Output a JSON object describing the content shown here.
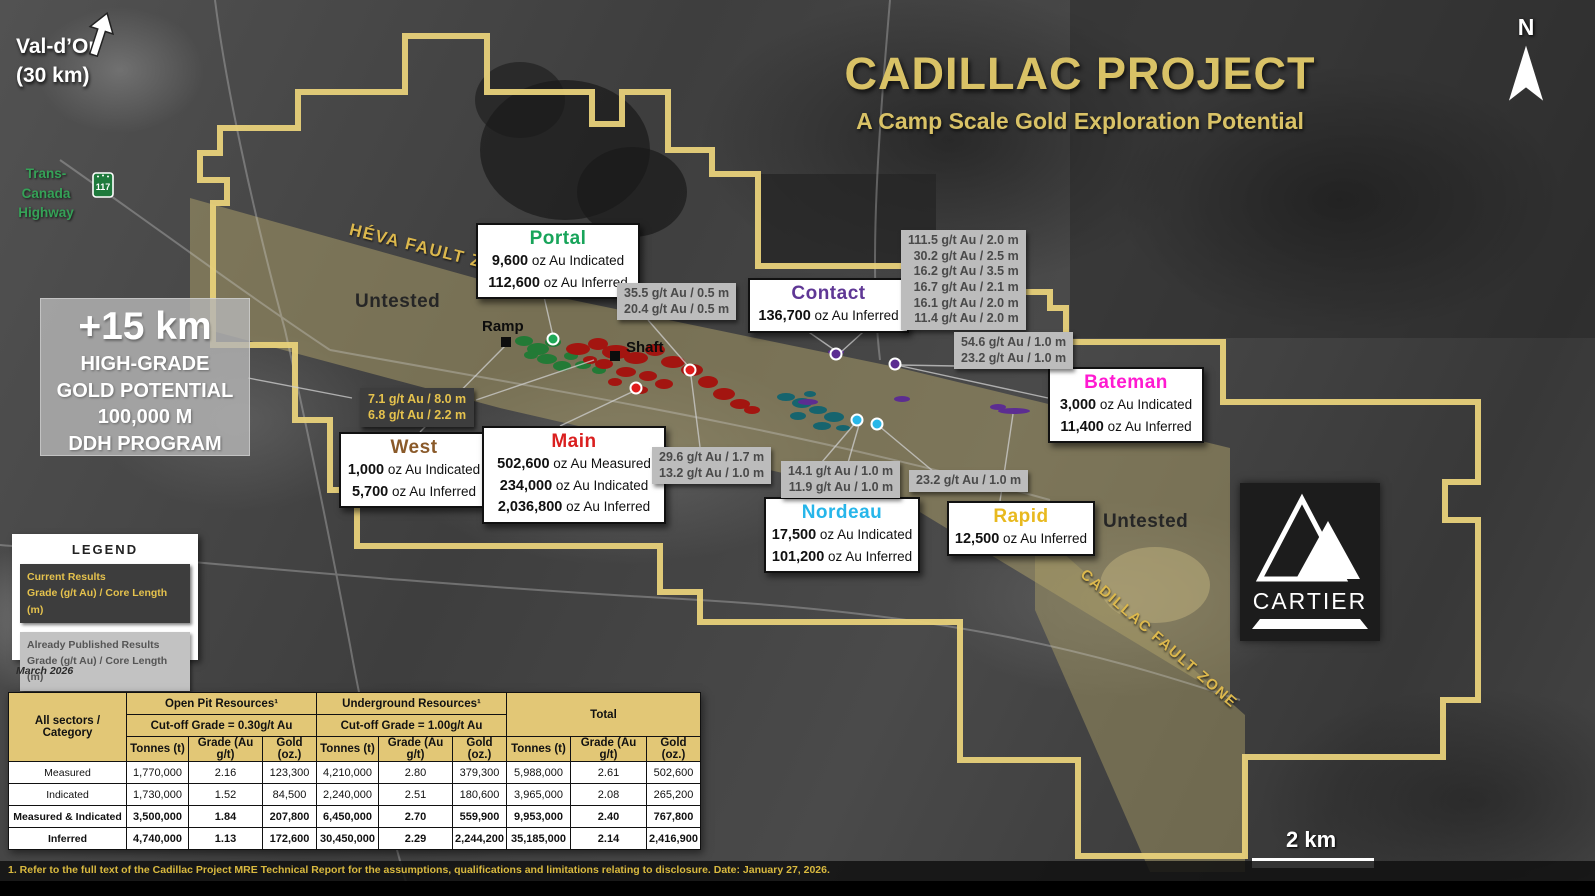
{
  "title_block": {
    "title": "CADILLAC PROJECT",
    "subtitle": "A Camp Scale Gold Exploration Potential"
  },
  "compass": {
    "label": "N"
  },
  "location": {
    "name": "Val-d’Or",
    "distance": "(30 km)"
  },
  "highway": {
    "line1": "Trans-Canada",
    "line2": "Highway",
    "shield": "117"
  },
  "map_labels": {
    "heva_fault": "HÉVA FAULT ZONE",
    "cadillac_fault": "CADILLAC FAULT ZONE",
    "untested_west": "Untested",
    "untested_east": "Untested",
    "ramp": "Ramp",
    "shaft": "Shaft"
  },
  "highlight": {
    "headline": "+15 km",
    "lines": [
      "HIGH-GRADE",
      "GOLD POTENTIAL",
      "100,000 M",
      "DDH PROGRAM"
    ]
  },
  "deposits": [
    {
      "id": "portal",
      "name": "Portal",
      "color": "#18a45a",
      "lines": [
        {
          "value": "9,600",
          "rest": " oz Au Indicated"
        },
        {
          "value": "112,600",
          "rest": " oz Au Inferred"
        }
      ]
    },
    {
      "id": "contact",
      "name": "Contact",
      "color": "#5f3795",
      "lines": [
        {
          "value": "136,700",
          "rest": " oz Au Inferred"
        }
      ]
    },
    {
      "id": "bateman",
      "name": "Bateman",
      "color": "#ff1ad1",
      "lines": [
        {
          "value": "3,000",
          "rest": " oz Au Indicated"
        },
        {
          "value": "11,400",
          "rest": " oz Au Inferred"
        }
      ]
    },
    {
      "id": "west",
      "name": "West",
      "color": "#8a5a2a",
      "lines": [
        {
          "value": "1,000",
          "rest": " oz Au Indicated"
        },
        {
          "value": "5,700",
          "rest": " oz Au Inferred"
        }
      ]
    },
    {
      "id": "main",
      "name": "Main",
      "color": "#da1f1f",
      "lines": [
        {
          "value": "502,600",
          "rest": " oz Au Measured"
        },
        {
          "value": "234,000",
          "rest": " oz Au Indicated"
        },
        {
          "value": "2,036,800",
          "rest": " oz Au Inferred"
        }
      ]
    },
    {
      "id": "nordeau",
      "name": "Nordeau",
      "color": "#27b6ea",
      "lines": [
        {
          "value": "17,500",
          "rest": " oz Au Indicated"
        },
        {
          "value": "101,200",
          "rest": " oz Au Inferred"
        }
      ]
    },
    {
      "id": "rapid",
      "name": "Rapid",
      "color": "#e8b91f",
      "lines": [
        {
          "value": "12,500",
          "rest": " oz Au Inferred"
        }
      ]
    }
  ],
  "current_results": {
    "lines": [
      "7.1 g/t Au / 8.0 m",
      "6.8 g/t Au / 2.2 m"
    ]
  },
  "published_results": [
    {
      "lines": [
        "35.5 g/t Au / 0.5 m",
        "20.4 g/t Au / 0.5 m"
      ]
    },
    {
      "lines": [
        "111.5 g/t Au / 2.0 m",
        "30.2 g/t Au / 2.5 m",
        "16.2 g/t Au / 3.5 m",
        "16.7 g/t Au / 2.1 m",
        "16.1 g/t Au / 2.0 m",
        "11.4 g/t Au / 2.0 m"
      ]
    },
    {
      "lines": [
        "54.6 g/t Au / 1.0 m",
        "23.2 g/t Au / 1.0 m"
      ]
    },
    {
      "lines": [
        "29.6 g/t Au / 1.7 m",
        "13.2 g/t Au / 1.0 m"
      ]
    },
    {
      "lines": [
        "14.1 g/t Au / 1.0 m",
        "11.9 g/t Au / 1.0 m"
      ]
    },
    {
      "lines": [
        "23.2 g/t Au / 1.0 m"
      ]
    }
  ],
  "legend": {
    "title": "LEGEND",
    "current_title": "Current Results",
    "current_sub": "Grade (g/t Au) / Core Length (m)",
    "published_title": "Already Published Results",
    "published_sub": "Grade (g/t Au) / Core Length (m)",
    "date": "March 2026"
  },
  "scalebar": {
    "label": "2 km"
  },
  "logo": {
    "text": "CARTIER"
  },
  "table": {
    "corner": "All sectors / Category",
    "groups": [
      {
        "title": "Open Pit Resources¹",
        "cutoff": "Cut-off Grade = 0.30g/t Au"
      },
      {
        "title": "Underground Resources¹",
        "cutoff": "Cut-off Grade = 1.00g/t Au"
      },
      {
        "title": "Total"
      }
    ],
    "columns": [
      "Tonnes (t)",
      "Grade (Au g/t)",
      "Gold (oz.)"
    ],
    "rows": [
      {
        "label": "Measured",
        "cells": [
          "1,770,000",
          "2.16",
          "123,300",
          "4,210,000",
          "2.80",
          "379,300",
          "5,988,000",
          "2.61",
          "502,600"
        ]
      },
      {
        "label": "Indicated",
        "cells": [
          "1,730,000",
          "1.52",
          "84,500",
          "2,240,000",
          "2.51",
          "180,600",
          "3,965,000",
          "2.08",
          "265,200"
        ]
      },
      {
        "label": "Measured & Indicated",
        "cells": [
          "3,500,000",
          "1.84",
          "207,800",
          "6,450,000",
          "2.70",
          "559,900",
          "9,953,000",
          "2.40",
          "767,800"
        ]
      },
      {
        "label": "Inferred",
        "cells": [
          "4,740,000",
          "1.13",
          "172,600",
          "30,450,000",
          "2.29",
          "2,244,200",
          "35,185,000",
          "2.14",
          "2,416,900"
        ]
      }
    ]
  },
  "footnote": "1. Refer to the full text of the Cadillac Project MRE Technical Report for the assumptions, qualifications and limitations relating to disclosure. Date: January 27, 2026.",
  "colors": {
    "accent_gold": "#d9c266",
    "boundary_gold": "#e8d17a",
    "fault_band": "#b0a169",
    "current_box_bg": "#3d3d3d",
    "current_text": "#e5c24d",
    "published_box_bg": "#bcbcbc",
    "table_header_bg": "#e2c776"
  }
}
